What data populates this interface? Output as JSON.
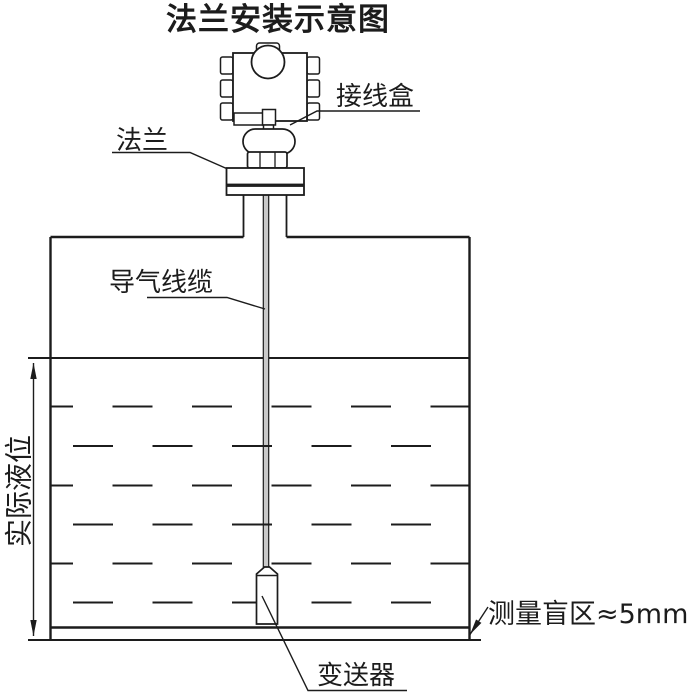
{
  "title": "法兰安装示意图",
  "colors": {
    "line": "#1c1c1c",
    "background": "#ffffff",
    "cable_fill": "#c9c9c9"
  },
  "labels": {
    "junction_box": "接线盒",
    "flange": "法兰",
    "air_cable": "导气线缆",
    "actual_level": "实际液位",
    "transmitter": "变送器",
    "blind_zone": "测量盲区≈5mm"
  }
}
